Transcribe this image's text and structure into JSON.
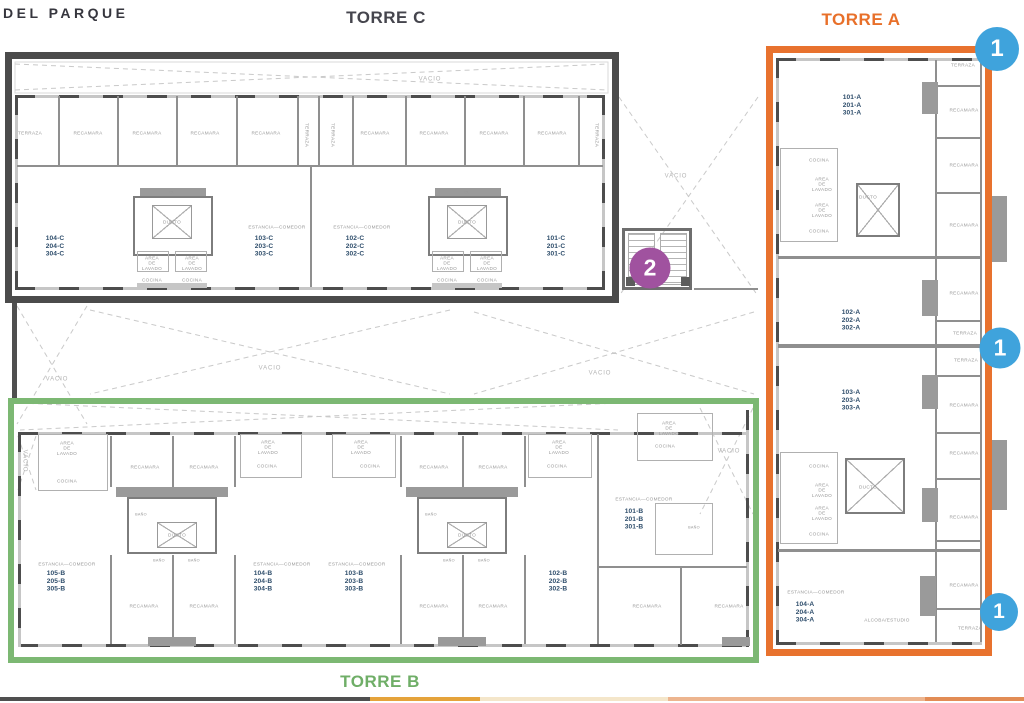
{
  "brand": {
    "name": "DEL PARQUE"
  },
  "titles": {
    "torre_c": "TORRE C",
    "torre_a": "TORRE A",
    "torre_b": "TORRE B"
  },
  "colors": {
    "torre_c_outline": "#4b4b4b",
    "torre_a_outline": "#e8722e",
    "torre_b_outline": "#7cb873",
    "marker_blue": "#3fa3dc",
    "marker_purple": "#a0529f",
    "unit_number_text": "#2e4d6b",
    "room_label_text": "#979797"
  },
  "markers": [
    {
      "label": "1",
      "x": 997,
      "y": 49,
      "d": 44,
      "color": "#3fa3dc"
    },
    {
      "label": "1",
      "x": 1000,
      "y": 348,
      "d": 41,
      "color": "#3fa3dc"
    },
    {
      "label": "1",
      "x": 999,
      "y": 612,
      "d": 38,
      "color": "#3fa3dc"
    },
    {
      "label": "2",
      "x": 650,
      "y": 268,
      "d": 41,
      "color": "#a0529f"
    }
  ],
  "unit_labels": [
    {
      "lines": [
        "104-C",
        "204-C",
        "304-C"
      ],
      "x": 55,
      "y": 234
    },
    {
      "lines": [
        "103-C",
        "203-C",
        "303-C"
      ],
      "x": 264,
      "y": 234
    },
    {
      "lines": [
        "102-C",
        "202-C",
        "302-C"
      ],
      "x": 355,
      "y": 234
    },
    {
      "lines": [
        "101-C",
        "201-C",
        "301-C"
      ],
      "x": 556,
      "y": 234
    },
    {
      "lines": [
        "105-B",
        "205-B",
        "305-B"
      ],
      "x": 56,
      "y": 569
    },
    {
      "lines": [
        "104-B",
        "204-B",
        "304-B"
      ],
      "x": 263,
      "y": 569
    },
    {
      "lines": [
        "103-B",
        "203-B",
        "303-B"
      ],
      "x": 354,
      "y": 569
    },
    {
      "lines": [
        "102-B",
        "202-B",
        "302-B"
      ],
      "x": 558,
      "y": 569
    },
    {
      "lines": [
        "101-B",
        "201-B",
        "301-B"
      ],
      "x": 634,
      "y": 507
    },
    {
      "lines": [
        "101-A",
        "201-A",
        "301-A"
      ],
      "x": 852,
      "y": 93
    },
    {
      "lines": [
        "102-A",
        "202-A",
        "302-A"
      ],
      "x": 851,
      "y": 308
    },
    {
      "lines": [
        "103-A",
        "203-A",
        "303-A"
      ],
      "x": 851,
      "y": 388
    },
    {
      "lines": [
        "104-A",
        "204-A",
        "304-A"
      ],
      "x": 805,
      "y": 600
    }
  ],
  "room_labels": [
    {
      "t": "TERRAZA",
      "x": 30,
      "y": 133
    },
    {
      "t": "RECAMARA",
      "x": 88,
      "y": 133
    },
    {
      "t": "RECAMARA",
      "x": 147,
      "y": 133
    },
    {
      "t": "RECAMARA",
      "x": 205,
      "y": 133
    },
    {
      "t": "RECAMARA",
      "x": 266,
      "y": 133
    },
    {
      "t": "TERRAZA",
      "x": 307,
      "y": 135,
      "v": 1
    },
    {
      "t": "TERRAZA",
      "x": 333,
      "y": 135,
      "v": 1
    },
    {
      "t": "RECAMARA",
      "x": 375,
      "y": 133
    },
    {
      "t": "RECAMARA",
      "x": 434,
      "y": 133
    },
    {
      "t": "RECAMARA",
      "x": 494,
      "y": 133
    },
    {
      "t": "RECAMARA",
      "x": 552,
      "y": 133
    },
    {
      "t": "TERRAZA",
      "x": 597,
      "y": 135,
      "v": 1
    },
    {
      "t": "ESTANCIA—COMEDOR",
      "x": 277,
      "y": 227
    },
    {
      "t": "ESTANCIA—COMEDOR",
      "x": 362,
      "y": 227
    },
    {
      "t": "DUCTO",
      "x": 172,
      "y": 222
    },
    {
      "t": "DUCTO",
      "x": 467,
      "y": 222
    },
    {
      "t": "CL",
      "x": 172,
      "y": 192,
      "cls": "xs"
    },
    {
      "t": "CL",
      "x": 467,
      "y": 192,
      "cls": "xs"
    },
    {
      "t": "AREA\nDE\nLAVADO",
      "x": 152,
      "y": 263
    },
    {
      "t": "AREA\nDE\nLAVADO",
      "x": 192,
      "y": 263
    },
    {
      "t": "AREA\nDE\nLAVADO",
      "x": 447,
      "y": 263
    },
    {
      "t": "AREA\nDE\nLAVADO",
      "x": 487,
      "y": 263
    },
    {
      "t": "COCINA",
      "x": 152,
      "y": 280
    },
    {
      "t": "COCINA",
      "x": 192,
      "y": 280
    },
    {
      "t": "COCINA",
      "x": 447,
      "y": 280
    },
    {
      "t": "COCINA",
      "x": 487,
      "y": 280
    },
    {
      "t": "VACIO",
      "x": 430,
      "y": 79,
      "cls": "vac"
    },
    {
      "t": "VACIO",
      "x": 676,
      "y": 176,
      "cls": "vac"
    },
    {
      "t": "VACIO",
      "x": 57,
      "y": 379,
      "cls": "vac"
    },
    {
      "t": "VACIO",
      "x": 270,
      "y": 368,
      "cls": "vac"
    },
    {
      "t": "VACIO",
      "x": 600,
      "y": 373,
      "cls": "vac"
    },
    {
      "t": "VACIO",
      "x": 729,
      "y": 451,
      "cls": "vac"
    },
    {
      "t": "VACIO",
      "x": 25,
      "y": 461,
      "cls": "vacv"
    },
    {
      "t": "AREA\nDE\nLAVADO",
      "x": 67,
      "y": 448
    },
    {
      "t": "COCINA",
      "x": 67,
      "y": 481
    },
    {
      "t": "RECAMARA",
      "x": 145,
      "y": 467
    },
    {
      "t": "RECAMARA",
      "x": 204,
      "y": 467
    },
    {
      "t": "AREA\nDE\nLAVADO",
      "x": 268,
      "y": 447
    },
    {
      "t": "COCINA",
      "x": 267,
      "y": 466
    },
    {
      "t": "AREA\nDE\nLAVADO",
      "x": 361,
      "y": 447
    },
    {
      "t": "COCINA",
      "x": 370,
      "y": 466
    },
    {
      "t": "RECAMARA",
      "x": 434,
      "y": 467
    },
    {
      "t": "RECAMARA",
      "x": 493,
      "y": 467
    },
    {
      "t": "AREA\nDE\nLAVADO",
      "x": 559,
      "y": 447
    },
    {
      "t": "COCINA",
      "x": 557,
      "y": 466
    },
    {
      "t": "AREA\nDE\nLAVADO",
      "x": 669,
      "y": 428
    },
    {
      "t": "COCINA",
      "x": 665,
      "y": 446
    },
    {
      "t": "BAÑO",
      "x": 141,
      "y": 514,
      "cls": "xs"
    },
    {
      "t": "BAÑO",
      "x": 431,
      "y": 514,
      "cls": "xs"
    },
    {
      "t": "DUCTO",
      "x": 177,
      "y": 535
    },
    {
      "t": "DUCTO",
      "x": 467,
      "y": 535
    },
    {
      "t": "BAÑO",
      "x": 159,
      "y": 560,
      "cls": "xs"
    },
    {
      "t": "BAÑO",
      "x": 194,
      "y": 560,
      "cls": "xs"
    },
    {
      "t": "BAÑO",
      "x": 449,
      "y": 560,
      "cls": "xs"
    },
    {
      "t": "BAÑO",
      "x": 484,
      "y": 560,
      "cls": "xs"
    },
    {
      "t": "ESTANCIA—COMEDOR",
      "x": 67,
      "y": 564
    },
    {
      "t": "ESTANCIA—COMEDOR",
      "x": 282,
      "y": 564
    },
    {
      "t": "ESTANCIA—COMEDOR",
      "x": 357,
      "y": 564
    },
    {
      "t": "ESTANCIA—COMEDOR",
      "x": 644,
      "y": 499
    },
    {
      "t": "BAÑO",
      "x": 694,
      "y": 527,
      "cls": "xs"
    },
    {
      "t": "RECAMARA",
      "x": 144,
      "y": 606
    },
    {
      "t": "RECAMARA",
      "x": 204,
      "y": 606
    },
    {
      "t": "RECAMARA",
      "x": 434,
      "y": 606
    },
    {
      "t": "RECAMARA",
      "x": 493,
      "y": 606
    },
    {
      "t": "RECAMARA",
      "x": 647,
      "y": 606
    },
    {
      "t": "RECAMARA",
      "x": 729,
      "y": 606
    },
    {
      "t": "TERRAZA",
      "x": 963,
      "y": 65
    },
    {
      "t": "RECAMARA",
      "x": 964,
      "y": 110
    },
    {
      "t": "COCINA",
      "x": 819,
      "y": 160
    },
    {
      "t": "RECAMARA",
      "x": 964,
      "y": 165
    },
    {
      "t": "AREA\nDE\nLAVADO",
      "x": 822,
      "y": 184
    },
    {
      "t": "DUCTO",
      "x": 868,
      "y": 197
    },
    {
      "t": "AREA\nDE\nLAVADO",
      "x": 822,
      "y": 210
    },
    {
      "t": "RECAMARA",
      "x": 964,
      "y": 225
    },
    {
      "t": "COCINA",
      "x": 819,
      "y": 231
    },
    {
      "t": "RECAMARA",
      "x": 964,
      "y": 293
    },
    {
      "t": "TERRAZA",
      "x": 965,
      "y": 333
    },
    {
      "t": "TERRAZA",
      "x": 966,
      "y": 360
    },
    {
      "t": "RECAMARA",
      "x": 964,
      "y": 405
    },
    {
      "t": "RECAMARA",
      "x": 964,
      "y": 453
    },
    {
      "t": "COCINA",
      "x": 819,
      "y": 466
    },
    {
      "t": "AREA\nDE\nLAVADO",
      "x": 822,
      "y": 490
    },
    {
      "t": "DUCTO",
      "x": 868,
      "y": 487
    },
    {
      "t": "AREA\nDE\nLAVADO",
      "x": 822,
      "y": 513
    },
    {
      "t": "RECAMARA",
      "x": 964,
      "y": 517
    },
    {
      "t": "COCINA",
      "x": 819,
      "y": 534
    },
    {
      "t": "ESTANCIA—COMEDOR",
      "x": 816,
      "y": 592
    },
    {
      "t": "RECAMARA",
      "x": 964,
      "y": 585
    },
    {
      "t": "ALCOBA/ESTUDIO",
      "x": 887,
      "y": 620
    },
    {
      "t": "TERRAZA",
      "x": 970,
      "y": 628
    }
  ],
  "footer_strip": {
    "segments": [
      {
        "color": "#4f4f4f",
        "width_px": 370
      },
      {
        "color": "#e5a33b",
        "width_px": 110
      },
      {
        "color": "#f4e6ca",
        "width_px": 188
      },
      {
        "color": "#edb58f",
        "width_px": 257
      },
      {
        "color": "#e28c55",
        "width_px": 99
      }
    ]
  }
}
